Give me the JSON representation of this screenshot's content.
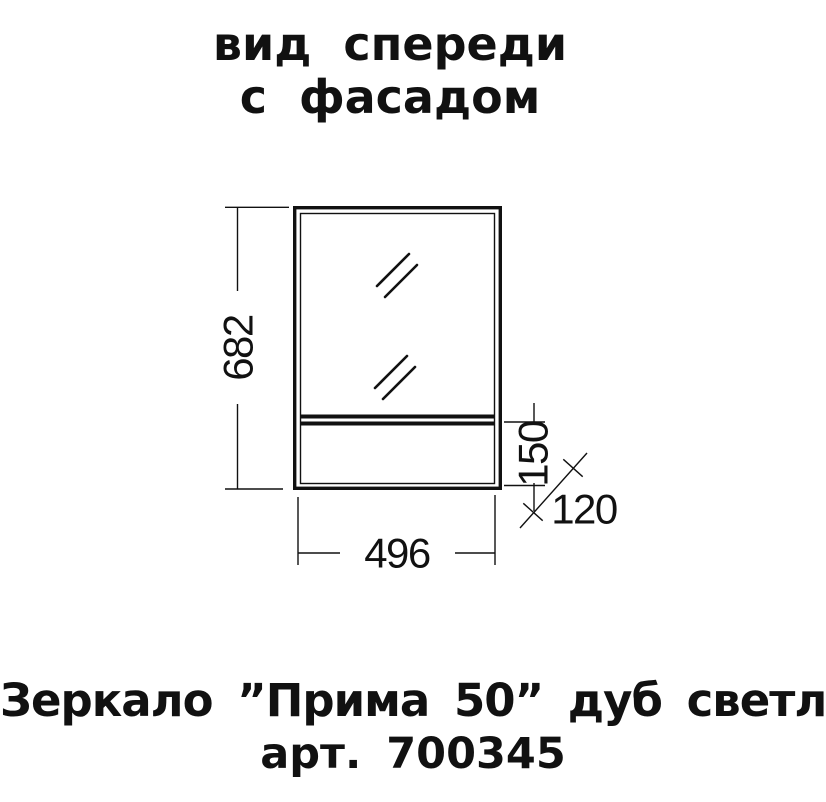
{
  "title": {
    "line1": "вид спереди",
    "line2": "с фасадом"
  },
  "drawing": {
    "dimensions": {
      "height_mm": "682",
      "width_mm": "496",
      "shelf_section_height_mm": "150",
      "depth_mm": "120"
    }
  },
  "caption": {
    "product": "Зеркало ”Прима 50” дуб светлый",
    "article": "арт. 700345"
  },
  "colors": {
    "ink": "#111111",
    "background": "#ffffff"
  }
}
